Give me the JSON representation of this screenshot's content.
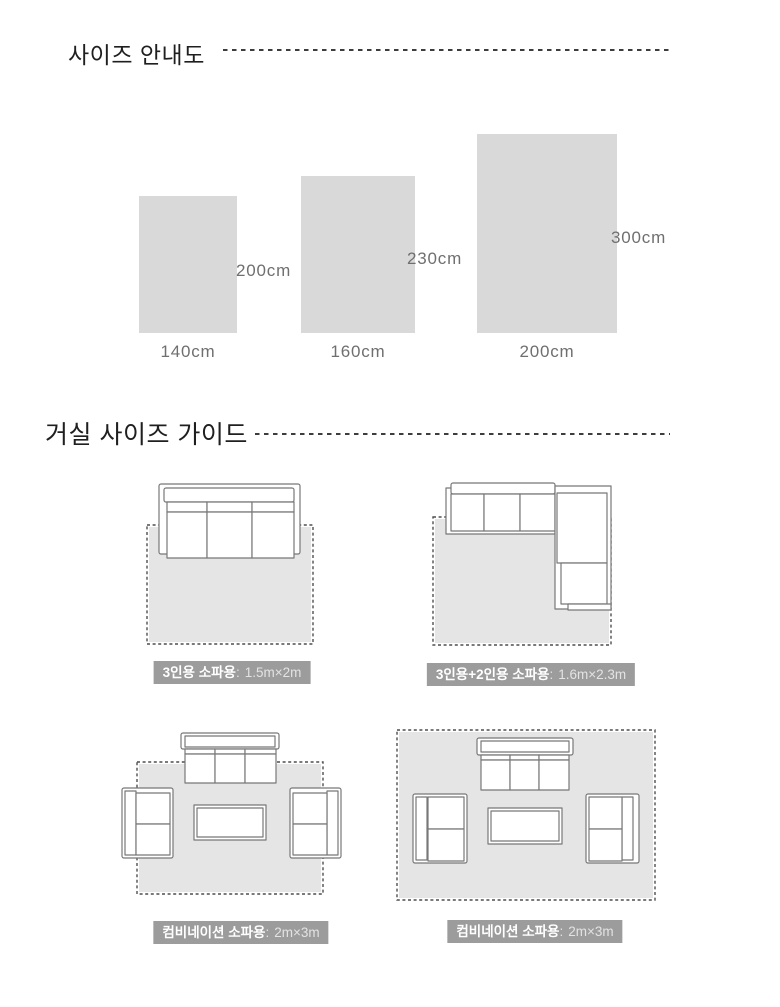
{
  "size_chart": {
    "title": "사이즈 안내도",
    "items": [
      {
        "width_label": "140cm",
        "height_label": "200cm"
      },
      {
        "width_label": "160cm",
        "height_label": "230cm"
      },
      {
        "width_label": "200cm",
        "height_label": "300cm"
      }
    ]
  },
  "living_guide": {
    "title": "거실 사이즈 가이드",
    "colon": ":",
    "layouts": [
      {
        "name": "3인용 소파용",
        "size": "1.5m×2m"
      },
      {
        "name": "3인용+2인용 소파용",
        "size": "1.6m×2.3m"
      },
      {
        "name": "컴비네이션 소파용",
        "size": "2m×3m"
      },
      {
        "name": "컴비네이션 소파용",
        "size": "2m×3m"
      }
    ]
  },
  "colors": {
    "rect_fill": "#d9d9d9",
    "rug_fill": "#e5e5e5",
    "rug_stroke": "#4f4f4f",
    "sofa_stroke": "#787878",
    "label_bg": "#9c9c9c",
    "label_text": "#ffffff",
    "label_value": "#e3e3e3",
    "dim_text": "#6f6f6f",
    "title_text": "#1f1f1f",
    "dash_color": "#3d3d3d"
  }
}
